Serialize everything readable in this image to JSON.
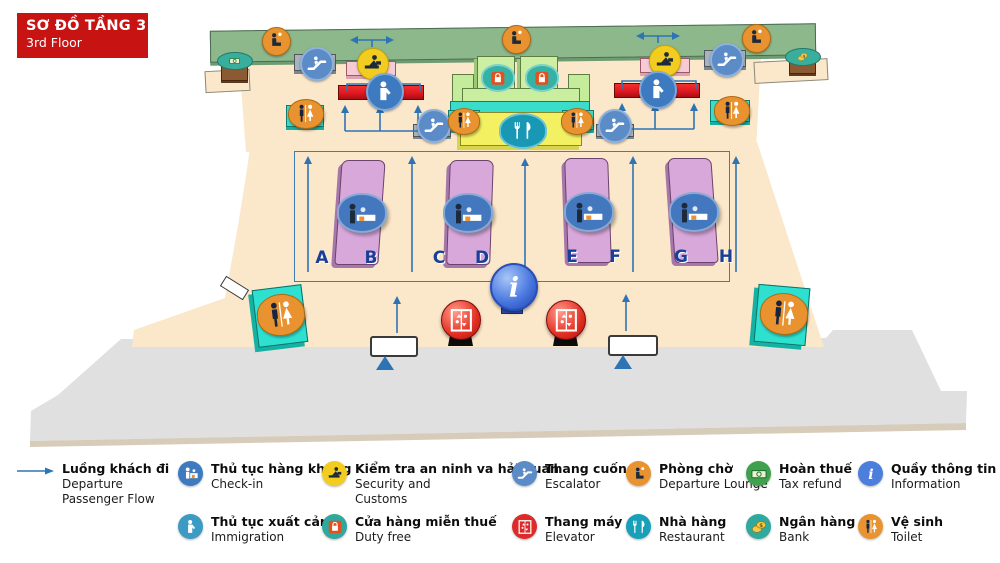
{
  "title": {
    "vi": "SƠ ĐỒ TẦNG 3",
    "en": "3rd Floor"
  },
  "islands": [
    {
      "left": "A",
      "right": "B"
    },
    {
      "left": "C",
      "right": "D"
    },
    {
      "left": "E",
      "right": "F"
    },
    {
      "left": "G",
      "right": "H"
    }
  ],
  "legend": {
    "rows": [
      [
        {
          "icon": "flow-arrow-icon",
          "color": "#2E75B6",
          "label_vi": "Luồng khách đi",
          "label_en": "Departure Passenger Flow"
        },
        {
          "icon": "check-in-icon",
          "color": "#3D7AC0",
          "label_vi": "Thủ tục hàng không",
          "label_en": "Check-in"
        },
        {
          "icon": "security-icon",
          "color": "#F2CD1F",
          "label_vi": "Kiểm tra an ninh va hải quan",
          "label_en": "Security and Customs"
        },
        {
          "icon": "escalator-icon",
          "color": "#5B8CC8",
          "label_vi": "Thang cuốn",
          "label_en": "Escalator"
        },
        {
          "icon": "departure-lounge-icon",
          "color": "#E8932F",
          "label_vi": "Phòng chờ",
          "label_en": "Departure Lounge"
        },
        {
          "icon": "tax-refund-icon",
          "color": "#3FA14E",
          "label_vi": "Hoàn thuế",
          "label_en": "Tax refund"
        },
        {
          "icon": "information-icon",
          "color": "#4C7EDC",
          "label_vi": "Quầy thông tin",
          "label_en": "Information"
        }
      ],
      [
        {
          "icon": "immigration-icon",
          "color": "#3B9BC4",
          "label_vi": "Thủ tục xuất cảnh",
          "label_en": "Immigration"
        },
        {
          "icon": "duty-free-icon",
          "color": "#2FA89E",
          "label_vi": "Cửa hàng miễn thuế",
          "label_en": "Duty free"
        },
        {
          "icon": "elevator-icon",
          "color": "#DD2A2A",
          "label_vi": "Thang máy",
          "label_en": "Elevator"
        },
        {
          "icon": "restaurant-icon",
          "color": "#17A0B8",
          "label_vi": "Nhà hàng",
          "label_en": "Restaurant"
        },
        {
          "icon": "bank-icon",
          "color": "#2FA89E",
          "label_vi": "Ngân hàng",
          "label_en": "Bank"
        },
        {
          "icon": "toilet-icon",
          "color": "#E8932F",
          "label_vi": "Vệ sinh",
          "label_en": "Toilet"
        }
      ]
    ]
  },
  "map": {
    "markers": [
      {
        "icon": "departure-lounge-icon",
        "type": "lounge",
        "x": 275,
        "y": 40
      },
      {
        "icon": "departure-lounge-icon",
        "type": "lounge",
        "x": 515,
        "y": 38
      },
      {
        "icon": "departure-lounge-icon",
        "type": "lounge",
        "x": 755,
        "y": 37
      },
      {
        "icon": "escalator-icon",
        "type": "esc",
        "x": 315,
        "y": 62
      },
      {
        "icon": "escalator-icon",
        "type": "esc",
        "x": 725,
        "y": 58
      },
      {
        "icon": "escalator-icon",
        "type": "esc",
        "x": 432,
        "y": 124
      },
      {
        "icon": "escalator-icon",
        "type": "esc",
        "x": 613,
        "y": 124
      },
      {
        "icon": "security-icon",
        "type": "sec",
        "x": 372,
        "y": 63
      },
      {
        "icon": "security-icon",
        "type": "sec",
        "x": 664,
        "y": 60
      },
      {
        "icon": "immigration-icon",
        "type": "imm",
        "x": 383,
        "y": 90
      },
      {
        "icon": "immigration-icon",
        "type": "imm",
        "x": 656,
        "y": 88
      },
      {
        "icon": "toilet-icon",
        "type": "wc",
        "x": 305,
        "y": 113
      },
      {
        "icon": "toilet-icon",
        "type": "wc",
        "x": 731,
        "y": 110
      },
      {
        "icon": "toilet-icon",
        "type": "wc",
        "x": 463,
        "y": 120,
        "w": 30,
        "h": 25
      },
      {
        "icon": "toilet-icon",
        "type": "wc",
        "x": 576,
        "y": 120,
        "w": 30,
        "h": 25
      },
      {
        "icon": "toilet-icon",
        "type": "wc",
        "x": 280,
        "y": 314,
        "w": 46,
        "h": 40,
        "r": -7
      },
      {
        "icon": "toilet-icon",
        "type": "wc",
        "x": 783,
        "y": 313,
        "w": 46,
        "h": 40,
        "r": 5
      },
      {
        "icon": "duty-free-icon",
        "type": "df",
        "x": 496,
        "y": 76
      },
      {
        "icon": "duty-free-icon",
        "type": "df",
        "x": 540,
        "y": 76
      },
      {
        "icon": "restaurant-icon",
        "type": "rest",
        "x": 521,
        "y": 129
      },
      {
        "icon": "check-in-map-icon",
        "type": "checkin",
        "x": 360,
        "y": 211
      },
      {
        "icon": "check-in-map-icon",
        "type": "checkin",
        "x": 466,
        "y": 211
      },
      {
        "icon": "check-in-map-icon",
        "type": "checkin",
        "x": 587,
        "y": 210
      },
      {
        "icon": "check-in-map-icon",
        "type": "checkin",
        "x": 692,
        "y": 210
      },
      {
        "icon": "information-icon",
        "type": "info",
        "x": 512,
        "y": 285
      },
      {
        "icon": "elevator-icon",
        "type": "elev",
        "x": 460,
        "y": 319
      },
      {
        "icon": "elevator-icon",
        "type": "elev",
        "x": 565,
        "y": 319
      },
      {
        "icon": "tax-refund-icon",
        "type": "tax",
        "x": 234,
        "y": 60
      },
      {
        "icon": "bank-icon",
        "type": "bank",
        "x": 802,
        "y": 56
      }
    ]
  },
  "colors": {
    "title_bg": "#C81313",
    "floor": "#FBE7C9",
    "corridor_green": "#8CB88C",
    "road": "#E0E0E0",
    "flow_blue": "#2E74B5",
    "island_purple": "#D9A8DB",
    "letter_blue": "#1A3F9A"
  }
}
